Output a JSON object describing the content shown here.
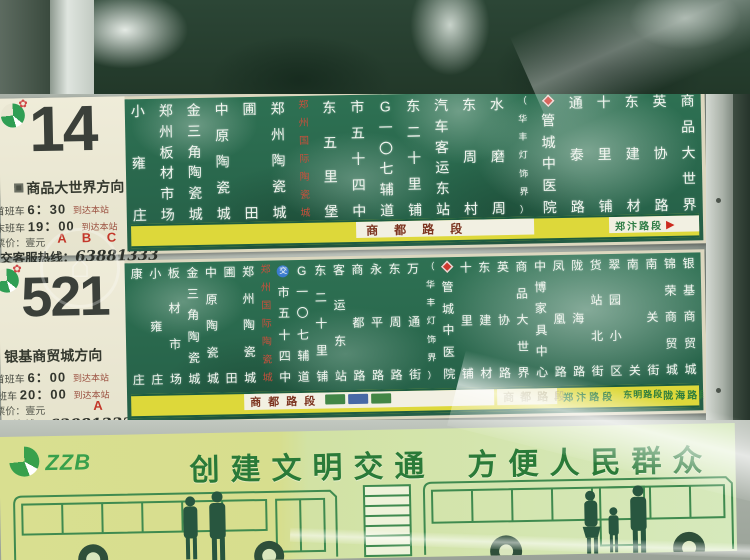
{
  "colors": {
    "board_green": "#2e7153",
    "strip_yellow": "#ddd83a",
    "accent_red": "#c3372a",
    "banner_green": "#2a7a38",
    "metal": "#ccd2ca"
  },
  "r14": {
    "number": "14",
    "direction": "商品大世界方向",
    "first_label": "首班车",
    "first_time": "6：30",
    "last_label": "末班车",
    "last_time": "19：00",
    "arrive": "到达本站",
    "fare": "票价：壹元",
    "zones": "A B C D",
    "hotline_label": "公交客服热线：",
    "hotline_number": "63881333",
    "strip_main": "商都路段",
    "strip_right": "郑汴路段",
    "strip_arrow": "▶",
    "stations": [
      {
        "n": "小雍庄"
      },
      {
        "n": "郑州板材市场"
      },
      {
        "n": "金三角陶瓷城"
      },
      {
        "n": "中原陶瓷城"
      },
      {
        "n": "圃田"
      },
      {
        "n": "郑州陶瓷城"
      },
      {
        "n": "郑州国际陶瓷城",
        "s": "red"
      },
      {
        "n": "东五里堡"
      },
      {
        "n": "市五十四中"
      },
      {
        "n": "G一〇七辅道"
      },
      {
        "n": "东二十里铺"
      },
      {
        "n": "汽车客运东站"
      },
      {
        "n": "东周村"
      },
      {
        "n": "水磨周"
      },
      {
        "n": "（华丰灯饰界）",
        "s": "sm"
      },
      {
        "n": "管城中医院",
        "b": "hosp"
      },
      {
        "n": "通泰路"
      },
      {
        "n": "十里铺"
      },
      {
        "n": "东建材"
      },
      {
        "n": "英协路"
      },
      {
        "n": "商品大世界"
      }
    ]
  },
  "r521": {
    "number": "521",
    "direction": "银基商贸城方向",
    "first_label": "首班车",
    "first_time": "6：00",
    "last_label": "末班车",
    "last_time": "20：00",
    "arrive": "到达本站",
    "fare": "票价：壹元",
    "zones": "A",
    "hotline_label": "公交客服热线：",
    "hotline_number": "63881333",
    "strip_main": "商都路段",
    "strip_ghost": "商都路段",
    "strip_segs": [
      "郑汴路段",
      "东明路段",
      "陇海路段"
    ],
    "chips": [
      "#2f7a35",
      "#355a9e",
      "#2f7a35"
    ],
    "stations": [
      {
        "n": "康庄"
      },
      {
        "n": "小雍庄"
      },
      {
        "n": "板材市场"
      },
      {
        "n": "金三角陶瓷城"
      },
      {
        "n": "中原陶瓷城"
      },
      {
        "n": "圃田"
      },
      {
        "n": "郑州陶瓷城"
      },
      {
        "n": "郑州国际陶瓷城",
        "s": "red"
      },
      {
        "n": "市五十四中",
        "b": "jiao"
      },
      {
        "n": "G一〇七辅道"
      },
      {
        "n": "东二十里铺"
      },
      {
        "n": "客运东站"
      },
      {
        "n": "商都路"
      },
      {
        "n": "永平路"
      },
      {
        "n": "东周路"
      },
      {
        "n": "万通街"
      },
      {
        "n": "（华丰灯饰界）",
        "s": "sm"
      },
      {
        "n": "管城中医院",
        "b": "hosp"
      },
      {
        "n": "十里铺"
      },
      {
        "n": "东建材"
      },
      {
        "n": "英协路"
      },
      {
        "n": "商品大世界"
      },
      {
        "n": "中博家具中心"
      },
      {
        "n": "凤凰路"
      },
      {
        "n": "陇海路"
      },
      {
        "n": "货站北街"
      },
      {
        "n": "翠园小区"
      },
      {
        "n": "南关"
      },
      {
        "n": "南关街"
      },
      {
        "n": "锦荣商贸城"
      },
      {
        "n": "银基商贸城"
      }
    ]
  },
  "banner": {
    "logo_text": "ZZB",
    "slogan_left": "创建文明交通",
    "slogan_right": "方便人民群众"
  },
  "badges": {
    "jiao_label": "交"
  }
}
